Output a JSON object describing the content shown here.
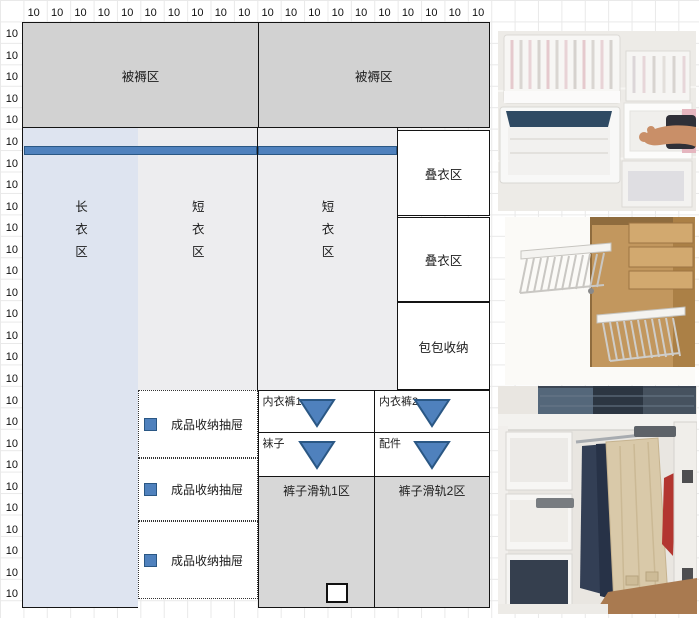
{
  "ruler": {
    "top": [
      "10",
      "10",
      "10",
      "10",
      "10",
      "10",
      "10",
      "10",
      "10",
      "10",
      "10",
      "10",
      "10",
      "10",
      "10",
      "10",
      "10",
      "10",
      "10",
      "10"
    ],
    "left": [
      "10",
      "10",
      "10",
      "10",
      "10",
      "10",
      "10",
      "10",
      "10",
      "10",
      "10",
      "10",
      "10",
      "10",
      "10",
      "10",
      "10",
      "10",
      "10",
      "10",
      "10",
      "10",
      "10",
      "10",
      "10",
      "10",
      "10"
    ]
  },
  "wardrobe": {
    "bedding_zone_left": "被褥区",
    "bedding_zone_right": "被褥区",
    "long_clothes_zone": "长衣区",
    "short_clothes_zone_1": "短衣区",
    "short_clothes_zone_2": "短衣区",
    "folded_zone_1": "叠衣区",
    "folded_zone_2": "叠衣区",
    "bag_storage_zone": "包包收纳",
    "underwear_drawer_1": "内衣裤1",
    "underwear_drawer_2": "内衣裤2",
    "socks_drawer": "袜子",
    "accessories_drawer": "配件",
    "storage_drawer_1": "成品收纳抽屉",
    "storage_drawer_2": "成品收纳抽屉",
    "storage_drawer_3": "成品收纳抽屉",
    "pants_rail_zone_1": "裤子滑轨1区",
    "pants_rail_zone_2": "裤子滑轨2区"
  },
  "colors": {
    "accent_blue": "#4f81bd",
    "accent_dark": "#2a5784",
    "rod_blue": "#4f81bd",
    "long_zone_fill": "#dee4f0",
    "short_zone_fill": "#ededef",
    "bedding_fill": "#d2d2d2",
    "rail_zone_fill": "#d7d7d7"
  }
}
